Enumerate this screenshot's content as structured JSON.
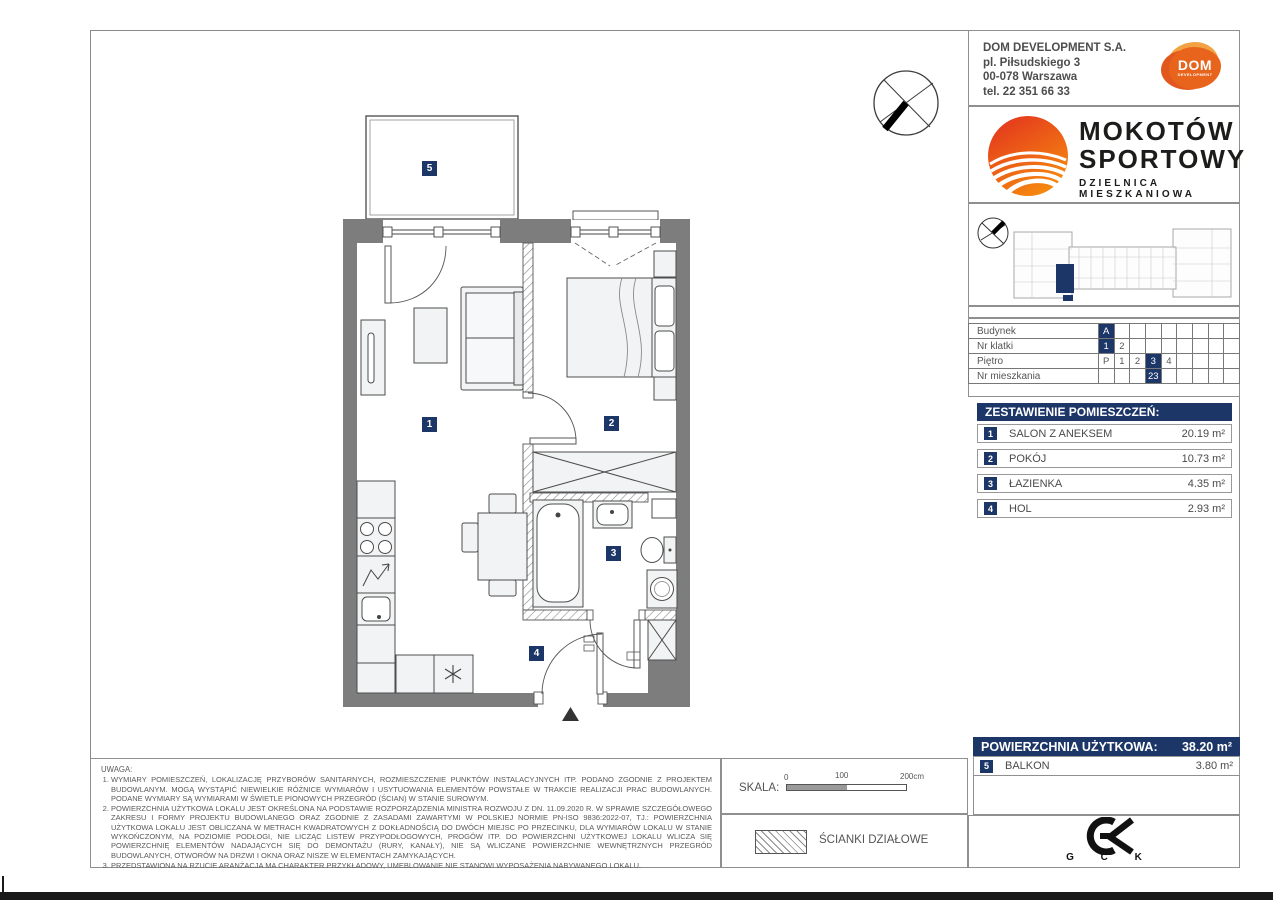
{
  "header": {
    "company": "DOM DEVELOPMENT S.A.",
    "address_line1": "pl. Piłsudskiego 3",
    "address_line2": "00-078 Warszawa",
    "phone": "tel. 22 351 66 33",
    "logo_text": "DOM",
    "logo_subtext": "DEVELOPMENT"
  },
  "brand": {
    "name_line1": "MOKOTÓW",
    "name_line2": "SPORTOWY",
    "tagline": "DZIELNICA MIESZKANIOWA",
    "accent_color": "#e2301f"
  },
  "unit_info": {
    "rows": [
      {
        "label": "Budynek",
        "cells": [
          "A",
          "",
          "",
          "",
          "",
          "",
          "",
          "",
          ""
        ],
        "highlight": [
          0
        ]
      },
      {
        "label": "Nr klatki",
        "cells": [
          "1",
          "2",
          "",
          "",
          "",
          "",
          "",
          "",
          ""
        ],
        "highlight": [
          0
        ]
      },
      {
        "label": "Piętro",
        "cells": [
          "P",
          "1",
          "2",
          "3",
          "4",
          "",
          "",
          "",
          ""
        ],
        "highlight": [
          3
        ]
      },
      {
        "label": "Nr mieszkania",
        "cells": [
          "",
          "",
          "",
          "23",
          "",
          "",
          "",
          "",
          ""
        ],
        "highlight": [
          3
        ]
      }
    ]
  },
  "rooms": {
    "title": "ZESTAWIENIE POMIESZCZEŃ:",
    "items": [
      {
        "no": "1",
        "name": "SALON Z ANEKSEM",
        "area": "20.19 m²"
      },
      {
        "no": "2",
        "name": "POKÓJ",
        "area": "10.73 m²"
      },
      {
        "no": "3",
        "name": "ŁAZIENKA",
        "area": "4.35 m²"
      },
      {
        "no": "4",
        "name": "HOL",
        "area": "2.93 m²"
      }
    ]
  },
  "summary": {
    "label": "POWIERZCHNIA UŻYTKOWA:",
    "value": "38.20 m²",
    "balcony": {
      "no": "5",
      "name": "BALKON",
      "area": "3.80 m²"
    },
    "highlight_color": "#1c3667"
  },
  "plan": {
    "room_labels": [
      {
        "no": "5",
        "x": 422,
        "y": 161
      },
      {
        "no": "1",
        "x": 422,
        "y": 417
      },
      {
        "no": "2",
        "x": 604,
        "y": 416
      },
      {
        "no": "3",
        "x": 606,
        "y": 546
      },
      {
        "no": "4",
        "x": 529,
        "y": 646
      }
    ]
  },
  "scale": {
    "label": "SKALA:",
    "tick0": "0",
    "tick1": "100",
    "tick2": "200cm"
  },
  "legend": {
    "partition_label": "ŚCIANKI DZIAŁOWE"
  },
  "gck": {
    "letters": "G C K"
  },
  "notes": {
    "title": "UWAGA:",
    "items": [
      "WYMIARY POMIESZCZEŃ, LOKALIZACJĘ PRZYBORÓW SANITARNYCH, ROZMIESZCZENIE PUNKTÓW INSTALACYJNYCH ITP. PODANO ZGODNIE Z PROJEKTEM BUDOWLANYM. MOGĄ WYSTĄPIĆ NIEWIELKIE RÓŻNICE WYMIARÓW I USYTUOWANIA ELEMENTÓW POWSTAŁE W TRAKCIE REALIZACJI PRAC BUDOWLANYCH. PODANE WYMIARY SĄ WYMIARAMI W ŚWIETLE PIONOWYCH PRZEGRÓD (ŚCIAN) W STANIE SUROWYM.",
      "POWIERZCHNIA UŻYTKOWA LOKALU JEST OKREŚLONA NA PODSTAWIE ROZPORZĄDZENIA MINISTRA ROZWOJU Z DN. 11.09.2020 R. W SPRAWIE SZCZEGÓŁOWEGO ZAKRESU I FORMY PROJEKTU BUDOWLANEGO ORAZ ZGODNIE Z ZASADAMI ZAWARTYMI W POLSKIEJ NORMIE PN-ISO 9836:2022-07, TJ.: POWIERZCHNIA UŻYTKOWA LOKALU JEST OBLICZANA W METRACH KWADRATOWYCH Z DOKŁADNOŚCIĄ DO DWÓCH MIEJSC PO PRZECINKU, DLA WYMIARÓW LOKALU W STANIE WYKOŃCZONYM, NA POZIOMIE PODŁOGI, NIE LICZĄC LISTEW PRZYPODŁOGOWYCH, PROGÓW ITP. DO POWIERZCHNI UŻYTKOWEJ LOKALU WLICZA SIĘ POWIERZCHNIĘ ELEMENTÓW NADAJĄCYCH SIĘ DO DEMONTAŻU (RURY, KANAŁY), NIE SĄ WLICZANE POWIERZCHNIE WEWNĘTRZNYCH PRZEGRÓD BUDOWLANYCH, OTWORÓW NA DRZWI I OKNA ORAZ NISZE W ELEMENTACH ZAMYKAJĄCYCH.",
      "PRZEDSTAWIONA NA RZUCIE ARANŻACJA MA CHARAKTER PRZYKŁADOWY, UMEBLOWANIE NIE STANOWI WYPOSAŻENIA NABYWANEGO LOKALU."
    ]
  }
}
